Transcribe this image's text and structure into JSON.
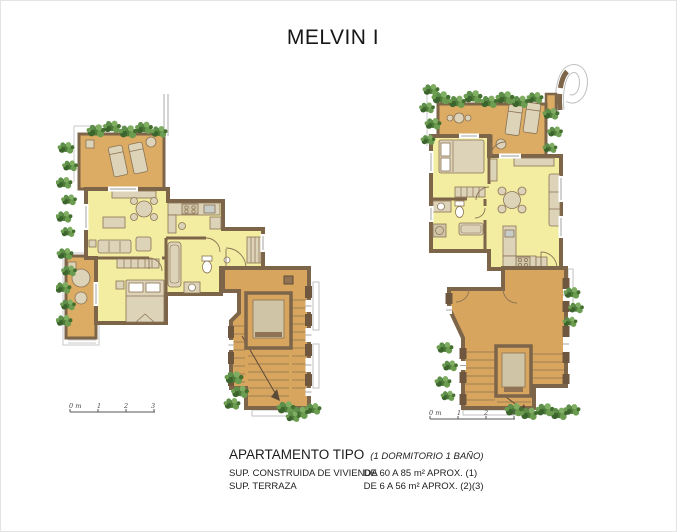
{
  "title": "MELVIN I",
  "footer": {
    "heading": "APARTAMENTO TIPO",
    "heading_note": "(1 DORMITORIO  1 BAÑO)",
    "rows": [
      {
        "label": "SUP. CONSTRUIDA DE VIVIENDA",
        "value": "DE 60 A 85 m² APROX. (1)"
      },
      {
        "label": "SUP. TERRAZA",
        "value": "DE 6 A 56 m² APROX.  (2)(3)"
      }
    ]
  },
  "plans": [
    {
      "id": "left-apartment-plan",
      "scale_bar": {
        "zero": "0 m",
        "ticks": [
          "1",
          "2",
          "3"
        ]
      }
    },
    {
      "id": "right-apartment-plan",
      "scale_bar": {
        "zero": "0 m",
        "ticks": [
          "1",
          "2",
          "3"
        ]
      }
    }
  ],
  "colors": {
    "wall": "#7d654a",
    "interior": "#f2eda1",
    "terrace": "#dcab64",
    "landing": "#d8a55e",
    "furniture": "#ddd3b8",
    "plant_dark": "#3f6d33",
    "plant_mid": "#5d8f4a",
    "plant_light": "#7fae63",
    "background": "#ffffff"
  }
}
